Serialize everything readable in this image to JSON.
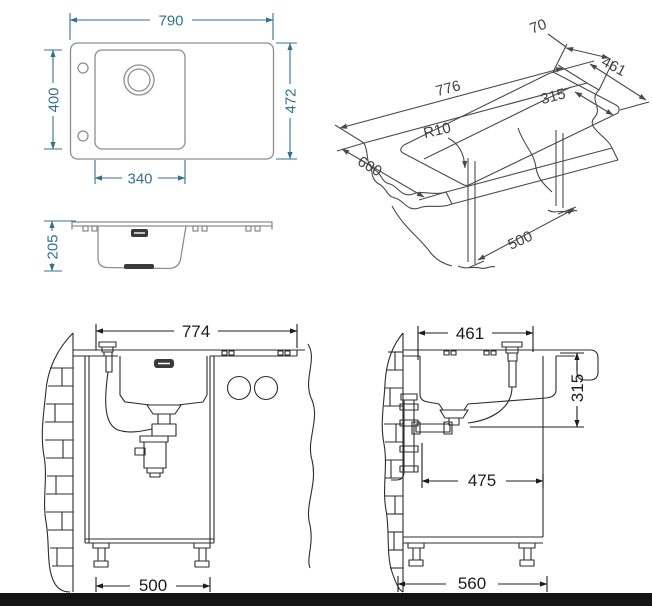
{
  "figure": {
    "kind": "kitchen-sink technical installation drawing",
    "colors": {
      "dimension_teal": "#35718e",
      "outline_gray": "#8e8e8e",
      "iso_line": "#4a4a4a",
      "section_line": "#2c2c2c",
      "footer_bar": "#151515",
      "dark_fill": "#3a3a3a"
    }
  },
  "views": {
    "plan": {
      "dim_width": "790",
      "dim_height": "472",
      "dim_bowl_height": "400",
      "dim_bowl_width": "340"
    },
    "profile": {
      "dim_depth": "205"
    },
    "iso": {
      "dim_cutout_length": "776",
      "dim_edge_offset": "70",
      "dim_cutout_depth": "461",
      "dim_bowl_cutout": "315",
      "dim_corner_radius": "R10",
      "dim_counter_depth": "600",
      "dim_cabinet_depth": "500"
    },
    "front_section": {
      "dim_top_width": "774",
      "dim_cabinet_width": "500"
    },
    "side_section": {
      "dim_top_width": "461",
      "dim_bowl_height": "315",
      "dim_mid_width": "475",
      "dim_cabinet_width": "560"
    }
  }
}
